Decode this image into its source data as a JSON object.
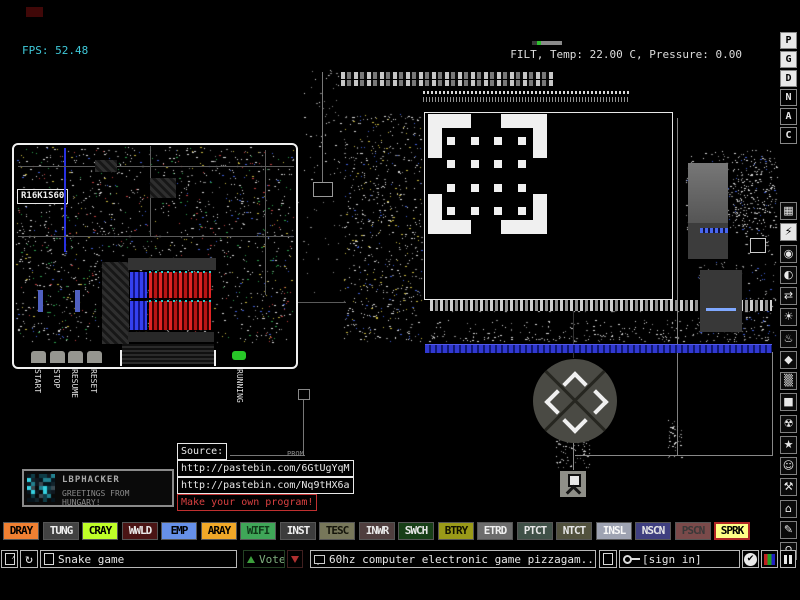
{
  "hud": {
    "fps": "FPS: 52.48",
    "fps_color": "#3FC8D8",
    "info": "FILT, Temp: 22.00 C, Pressure: 0.00"
  },
  "board": {
    "label": "R16K1S60",
    "buttons": [
      "START",
      "STOP",
      "RESUME",
      "RESET"
    ],
    "status": "RUNNING"
  },
  "dpad": [
    "up",
    "down",
    "left",
    "right"
  ],
  "source_panel": {
    "title": "Source:",
    "links": [
      "http://pastebin.com/6GtUgYqM",
      "http://pastebin.com/Nq9tHX6a"
    ],
    "cta": "Make your own program!",
    "chip_label": "PROM"
  },
  "signature": {
    "name": "LBPHACKER",
    "subtitle": "GREETINGS FROM HUNGARY!"
  },
  "sidebar": {
    "letters": [
      {
        "label": "P",
        "active": true
      },
      {
        "label": "G",
        "active": true
      },
      {
        "label": "D",
        "active": true
      },
      {
        "label": "N",
        "active": false
      },
      {
        "label": "A",
        "active": false
      },
      {
        "label": "C",
        "active": false
      }
    ],
    "menus": [
      {
        "name": "keyboard-menu-icon",
        "glyph": "▦",
        "active": false
      },
      {
        "name": "electronics-menu-icon",
        "glyph": "⚡",
        "active": true
      },
      {
        "name": "powered-menu-icon",
        "glyph": "◉",
        "active": false
      },
      {
        "name": "sensors-menu-icon",
        "glyph": "◐",
        "active": false
      },
      {
        "name": "force-menu-icon",
        "glyph": "⇄",
        "active": false
      },
      {
        "name": "explosives-menu-icon",
        "glyph": "☀",
        "active": false
      },
      {
        "name": "gases-menu-icon",
        "glyph": "♨",
        "active": false
      },
      {
        "name": "liquids-menu-icon",
        "glyph": "◆",
        "active": false
      },
      {
        "name": "powders-menu-icon",
        "glyph": "▒",
        "active": false
      },
      {
        "name": "solids-menu-icon",
        "glyph": "■",
        "active": false
      },
      {
        "name": "radioactive-menu-icon",
        "glyph": "☢",
        "active": false
      },
      {
        "name": "special-menu-icon",
        "glyph": "★",
        "active": false
      },
      {
        "name": "life-menu-icon",
        "glyph": "☺",
        "active": false
      },
      {
        "name": "tools-menu-icon",
        "glyph": "⚒",
        "active": false
      },
      {
        "name": "favorites-menu-icon",
        "glyph": "⌂",
        "active": false
      },
      {
        "name": "decoration-menu-icon",
        "glyph": "✎",
        "active": false
      },
      {
        "name": "search-menu-icon",
        "glyph": "⚲",
        "active": false
      }
    ]
  },
  "palette": [
    {
      "label": "DRAY",
      "bg": "#F08032",
      "fg": "#000000",
      "selected": false
    },
    {
      "label": "TUNG",
      "bg": "#424242",
      "fg": "#F0F0F0",
      "selected": false
    },
    {
      "label": "CRAY",
      "bg": "#BFFF28",
      "fg": "#000000",
      "selected": false
    },
    {
      "label": "WWLD",
      "bg": "#4A1414",
      "fg": "#E8E8E8",
      "selected": false
    },
    {
      "label": "EMP",
      "bg": "#6690E8",
      "fg": "#000000",
      "selected": false
    },
    {
      "label": "ARAY",
      "bg": "#F0A828",
      "fg": "#000000",
      "selected": false
    },
    {
      "label": "WIFI",
      "bg": "#3FA658",
      "fg": "#103818",
      "selected": false
    },
    {
      "label": "INST",
      "bg": "#3C3C3C",
      "fg": "#F0F0F0",
      "selected": false
    },
    {
      "label": "TESC",
      "bg": "#77775A",
      "fg": "#14140A",
      "selected": false
    },
    {
      "label": "INWR",
      "bg": "#4F3E3E",
      "fg": "#E8E8E8",
      "selected": false
    },
    {
      "label": "SWCH",
      "bg": "#173F17",
      "fg": "#E8E8E8",
      "selected": false
    },
    {
      "label": "BTRY",
      "bg": "#9A9A18",
      "fg": "#101000",
      "selected": false
    },
    {
      "label": "ETRD",
      "bg": "#6C6C6C",
      "fg": "#F0F0F0",
      "selected": false
    },
    {
      "label": "PTCT",
      "bg": "#405148",
      "fg": "#E8E8E8",
      "selected": false
    },
    {
      "label": "NTCT",
      "bg": "#52523E",
      "fg": "#E8E8E8",
      "selected": false
    },
    {
      "label": "INSL",
      "bg": "#9EA3B2",
      "fg": "#F8F8F8",
      "selected": false
    },
    {
      "label": "NSCN",
      "bg": "#3F3F80",
      "fg": "#E8E8E8",
      "selected": false
    },
    {
      "label": "PSCN",
      "bg": "#7A4A4A",
      "fg": "#383838",
      "selected": false
    },
    {
      "label": "SPRK",
      "bg": "#FFFF86",
      "fg": "#000000",
      "selected": true,
      "border": "#B02828"
    }
  ],
  "toolbar": {
    "save_name": "Snake game",
    "vote_label": "Vote",
    "tag_text": "60hz computer electronic game pizzagam...",
    "sign_in": "[sign in]"
  }
}
